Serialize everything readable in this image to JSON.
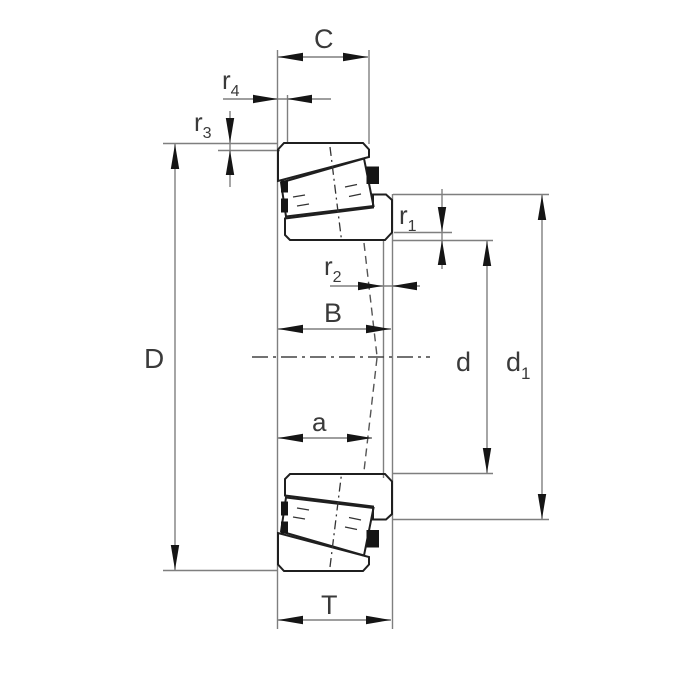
{
  "figure": {
    "title": "tapered roller bearing cross-section dimension drawing",
    "type": "technical-drawing",
    "background_color": "#ffffff",
    "colors": {
      "object_line": "#1f1f1f",
      "dimension_line": "#7f7f7f",
      "label_text": "#3a3a3a",
      "hatch": "#1f1f1f"
    },
    "labels": {
      "outer_ring_width": {
        "base": "C",
        "sub": ""
      },
      "chamfer_r4": {
        "base": "r",
        "sub": "4"
      },
      "chamfer_r3": {
        "base": "r",
        "sub": "3"
      },
      "outside_diameter": {
        "base": "D",
        "sub": ""
      },
      "inner_ring_width": {
        "base": "B",
        "sub": ""
      },
      "pressure_center_distance": {
        "base": "a",
        "sub": ""
      },
      "total_width": {
        "base": "T",
        "sub": ""
      },
      "chamfer_r1": {
        "base": "r",
        "sub": "1"
      },
      "chamfer_r2": {
        "base": "r",
        "sub": "2"
      },
      "bore_diameter": {
        "base": "d",
        "sub": ""
      },
      "rib_diameter": {
        "base": "d",
        "sub": "1"
      }
    }
  }
}
